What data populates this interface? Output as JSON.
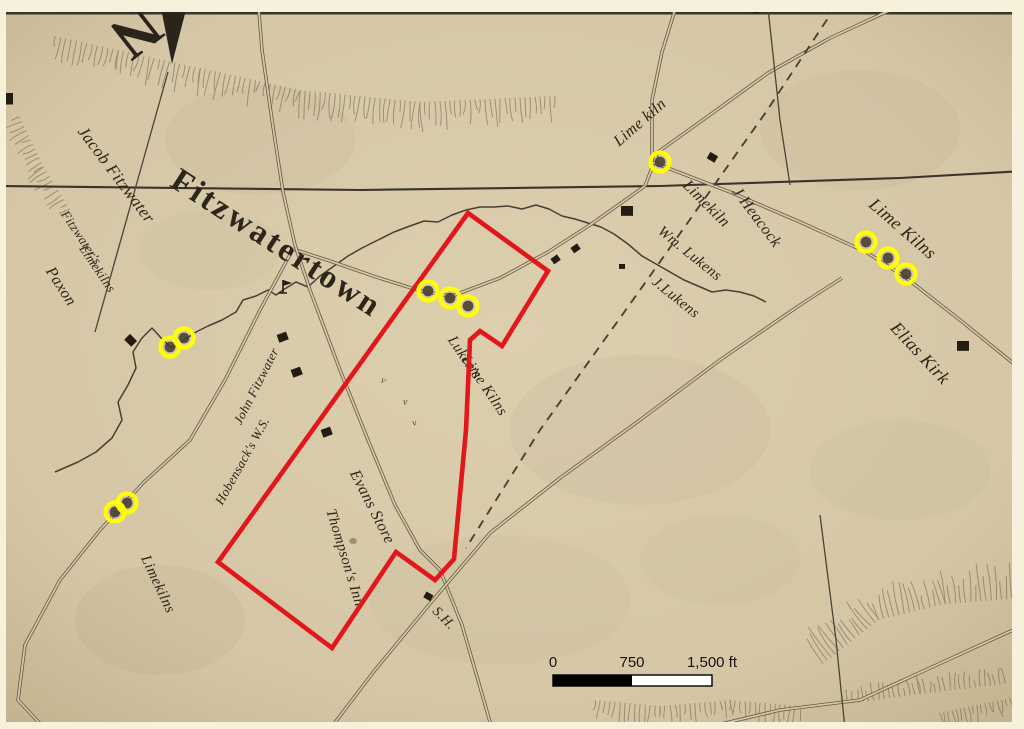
{
  "annotations": {
    "highlight_color": "#ffff00",
    "outline_color": "#e2161b",
    "highlight_meaning": "limekiln-site-circle",
    "outline_meaning": "study-area-polygon"
  },
  "scalebar": {
    "labels": [
      {
        "id": "start",
        "text": "0"
      },
      {
        "id": "mid",
        "text": "750"
      },
      {
        "id": "end",
        "text": "1,500 ft"
      }
    ],
    "bar": {
      "x": 553,
      "y": 675,
      "w": 159,
      "h": 11,
      "mid": 632
    }
  },
  "map": {
    "paper": "#d5c7a6",
    "border": "#f7f0db",
    "ink": "#2c2519",
    "road_ink": "#645847",
    "compass": {
      "letter": "N",
      "x": 124,
      "y": 16,
      "rot": 142,
      "size": 62,
      "arrow": [
        [
          172,
          64
        ],
        [
          159,
          -2
        ],
        [
          187,
          6
        ]
      ]
    },
    "labels": [
      {
        "id": "jacob-fitzwater",
        "text": "Jacob Fitzwater",
        "x": 112,
        "y": 178,
        "rot": 53,
        "size": 17,
        "italic": true
      },
      {
        "id": "fitzwatertown",
        "text": "Fitzwatertown",
        "x": 271,
        "y": 252,
        "rot": 33,
        "size": 33,
        "italic": false,
        "bold": true,
        "spacing": 3
      },
      {
        "id": "fitzwaters",
        "text": "Fitzwater's",
        "x": 78,
        "y": 240,
        "rot": 56,
        "size": 13,
        "italic": true
      },
      {
        "id": "fitzwaters-limekilns",
        "text": "Limekilns",
        "x": 94,
        "y": 271,
        "rot": 56,
        "size": 13,
        "italic": true
      },
      {
        "id": "paxon",
        "text": "Paxon",
        "x": 57,
        "y": 289,
        "rot": 57,
        "size": 16,
        "italic": true
      },
      {
        "id": "lime-kiln-top",
        "text": "Lime kiln",
        "x": 643,
        "y": 126,
        "rot": -41,
        "size": 16,
        "italic": true
      },
      {
        "id": "limekiln-mid",
        "text": "Limekiln",
        "x": 703,
        "y": 207,
        "rot": 45,
        "size": 16,
        "italic": true
      },
      {
        "id": "j-heacock",
        "text": "J Heacock",
        "x": 753,
        "y": 220,
        "rot": 53,
        "size": 16,
        "italic": true
      },
      {
        "id": "wm-lukens",
        "text": "Wm. Lukens",
        "x": 687,
        "y": 257,
        "rot": 39,
        "size": 15,
        "italic": true
      },
      {
        "id": "j-lukens",
        "text": "J.Lukens",
        "x": 673,
        "y": 301,
        "rot": 39,
        "size": 15,
        "italic": true
      },
      {
        "id": "lime-kilns-ne",
        "text": "Lime Kilns",
        "x": 899,
        "y": 233,
        "rot": 41,
        "size": 18,
        "italic": true
      },
      {
        "id": "elias-kirk",
        "text": "Elias Kirk",
        "x": 916,
        "y": 357,
        "rot": 47,
        "size": 18,
        "italic": true
      },
      {
        "id": "lukens-line1",
        "text": "Luken's",
        "x": 461,
        "y": 360,
        "rot": 56,
        "size": 15,
        "italic": true
      },
      {
        "id": "lukens-line2",
        "text": "Lime Kilns",
        "x": 481,
        "y": 388,
        "rot": 56,
        "size": 15,
        "italic": true
      },
      {
        "id": "john-fitzwater",
        "text": "John Fitzwater",
        "x": 260,
        "y": 388,
        "rot": -63,
        "size": 13,
        "italic": true
      },
      {
        "id": "hobensacks",
        "text": "Hobensack's W.S.",
        "x": 246,
        "y": 463,
        "rot": -61,
        "size": 13,
        "italic": true
      },
      {
        "id": "evans-store",
        "text": "Evans Store",
        "x": 368,
        "y": 509,
        "rot": 63,
        "size": 16,
        "italic": true
      },
      {
        "id": "thompsons-inn",
        "text": "Thompson's Inn",
        "x": 341,
        "y": 559,
        "rot": 73,
        "size": 15,
        "italic": true
      },
      {
        "id": "sh",
        "text": "S.H.",
        "x": 441,
        "y": 621,
        "rot": 45,
        "size": 14,
        "italic": true
      },
      {
        "id": "limekilns-sw",
        "text": "Limekilns",
        "x": 154,
        "y": 586,
        "rot": 65,
        "size": 15,
        "italic": true
      }
    ],
    "roads": [
      {
        "single": true,
        "pts": [
          [
            0,
            186
          ],
          [
            360,
            190
          ],
          [
            660,
            186
          ],
          [
            900,
            178
          ],
          [
            1024,
            171
          ]
        ]
      },
      {
        "pts": [
          [
            912,
            0
          ],
          [
            830,
            38
          ],
          [
            768,
            73
          ],
          [
            700,
            122
          ],
          [
            658,
            152
          ],
          [
            645,
            186
          ]
        ]
      },
      {
        "pts": [
          [
            645,
            186
          ],
          [
            590,
            225
          ],
          [
            548,
            252
          ],
          [
            500,
            278
          ],
          [
            452,
            296
          ],
          [
            424,
            292
          ]
        ]
      },
      {
        "pts": [
          [
            424,
            292
          ],
          [
            376,
            277
          ],
          [
            330,
            261
          ],
          [
            293,
            249
          ]
        ]
      },
      {
        "pts": [
          [
            652,
            162
          ],
          [
            730,
            192
          ],
          [
            800,
            222
          ],
          [
            866,
            252
          ],
          [
            905,
            277
          ],
          [
            960,
            320
          ],
          [
            1024,
            372
          ]
        ]
      },
      {
        "pts": [
          [
            283,
            192
          ],
          [
            295,
            245
          ],
          [
            310,
            290
          ],
          [
            340,
            370
          ],
          [
            368,
            440
          ],
          [
            395,
            505
          ],
          [
            420,
            550
          ],
          [
            440,
            570
          ]
        ]
      },
      {
        "pts": [
          [
            440,
            570
          ],
          [
            462,
            625
          ],
          [
            478,
            680
          ],
          [
            492,
            729
          ]
        ]
      },
      {
        "pts": [
          [
            330,
            729
          ],
          [
            375,
            670
          ],
          [
            428,
            606
          ],
          [
            490,
            533
          ],
          [
            560,
            478
          ],
          [
            640,
            420
          ],
          [
            720,
            360
          ],
          [
            800,
            305
          ],
          [
            842,
            278
          ]
        ]
      },
      {
        "pts": [
          [
            700,
            729
          ],
          [
            780,
            710
          ],
          [
            860,
            700
          ],
          [
            930,
            668
          ],
          [
            1024,
            625
          ]
        ]
      },
      {
        "pts": [
          [
            293,
            249
          ],
          [
            260,
            310
          ],
          [
            225,
            380
          ],
          [
            190,
            440
          ],
          [
            143,
            483
          ],
          [
            100,
            530
          ],
          [
            60,
            580
          ],
          [
            25,
            645
          ],
          [
            18,
            700
          ],
          [
            45,
            729
          ]
        ]
      },
      {
        "pts": [
          [
            283,
            192
          ],
          [
            272,
            120
          ],
          [
            262,
            50
          ],
          [
            258,
            0
          ]
        ]
      },
      {
        "pts": [
          [
            678,
            0
          ],
          [
            662,
            52
          ],
          [
            652,
            100
          ],
          [
            652,
            162
          ]
        ]
      }
    ],
    "property_lines": [
      [
        [
          168,
          72
        ],
        [
          95,
          332
        ]
      ],
      [
        [
          768,
          8
        ],
        [
          780,
          120
        ],
        [
          790,
          185
        ]
      ],
      [
        [
          820,
          515
        ],
        [
          836,
          640
        ],
        [
          845,
          729
        ]
      ]
    ],
    "dashed_lines": [
      [
        [
          836,
          6
        ],
        [
          766,
          112
        ],
        [
          640,
          290
        ],
        [
          540,
          430
        ],
        [
          466,
          548
        ]
      ]
    ],
    "creek": [
      [
        55,
        472
      ],
      [
        78,
        462
      ],
      [
        96,
        452
      ],
      [
        112,
        438
      ],
      [
        122,
        420
      ],
      [
        118,
        402
      ],
      [
        128,
        385
      ],
      [
        136,
        368
      ],
      [
        133,
        352
      ],
      [
        142,
        338
      ],
      [
        152,
        328
      ],
      [
        163,
        340
      ],
      [
        172,
        348
      ],
      [
        184,
        340
      ],
      [
        196,
        332
      ],
      [
        208,
        326
      ],
      [
        222,
        320
      ],
      [
        236,
        312
      ],
      [
        243,
        300
      ],
      [
        256,
        296
      ],
      [
        268,
        290
      ],
      [
        276,
        295
      ],
      [
        283,
        290
      ],
      [
        296,
        282
      ],
      [
        308,
        287
      ],
      [
        320,
        276
      ],
      [
        334,
        266
      ],
      [
        348,
        256
      ],
      [
        362,
        248
      ],
      [
        378,
        240
      ],
      [
        394,
        232
      ],
      [
        410,
        226
      ],
      [
        424,
        221
      ],
      [
        438,
        222
      ],
      [
        452,
        215
      ],
      [
        466,
        210
      ],
      [
        480,
        207
      ],
      [
        494,
        207
      ],
      [
        508,
        206
      ],
      [
        522,
        209
      ],
      [
        536,
        205
      ],
      [
        549,
        209
      ],
      [
        562,
        216
      ],
      [
        575,
        219
      ],
      [
        588,
        223
      ],
      [
        601,
        227
      ],
      [
        614,
        234
      ],
      [
        628,
        244
      ],
      [
        642,
        256
      ],
      [
        656,
        264
      ],
      [
        670,
        272
      ],
      [
        684,
        280
      ],
      [
        698,
        286
      ],
      [
        712,
        292
      ],
      [
        726,
        290
      ],
      [
        740,
        292
      ],
      [
        754,
        296
      ],
      [
        766,
        302
      ]
    ],
    "buildings": [
      [
        6,
        100,
        14,
        0
      ],
      [
        130,
        341,
        10,
        45
      ],
      [
        283,
        338,
        10,
        -20
      ],
      [
        297,
        373,
        10,
        -20
      ],
      [
        327,
        433,
        10,
        -20
      ],
      [
        627,
        212,
        12,
        0
      ],
      [
        712,
        158,
        9,
        30
      ],
      [
        622,
        267,
        6,
        0
      ],
      [
        556,
        260,
        8,
        -35
      ],
      [
        576,
        249,
        8,
        -35
      ],
      [
        963,
        347,
        12,
        0
      ],
      [
        428,
        597,
        8,
        30
      ],
      [
        755,
        10,
        9,
        15
      ]
    ],
    "kiln_circles": [
      [
        660,
        162
      ],
      [
        866,
        242
      ],
      [
        888,
        258
      ],
      [
        906,
        274
      ],
      [
        428,
        291
      ],
      [
        450,
        298
      ],
      [
        468,
        306
      ],
      [
        170,
        347
      ],
      [
        184,
        338
      ],
      [
        115,
        512
      ],
      [
        127,
        503
      ]
    ],
    "polygon": [
      [
        468,
        213
      ],
      [
        548,
        271
      ],
      [
        502,
        346
      ],
      [
        480,
        331
      ],
      [
        470,
        340
      ],
      [
        466,
        430
      ],
      [
        454,
        559
      ],
      [
        435,
        580
      ],
      [
        396,
        552
      ],
      [
        332,
        648
      ],
      [
        218,
        562
      ]
    ],
    "hachures": [
      {
        "ridge": [
          [
            55,
            38
          ],
          [
            118,
            52
          ],
          [
            200,
            70
          ],
          [
            300,
            92
          ],
          [
            420,
            104
          ],
          [
            555,
            98
          ]
        ],
        "len": 20,
        "spacing": 5,
        "side": 1
      },
      {
        "ridge": [
          [
            18,
            118
          ],
          [
            42,
            168
          ],
          [
            68,
            210
          ]
        ],
        "len": 14,
        "spacing": 5,
        "side": 1
      },
      {
        "ridge": [
          [
            822,
            662
          ],
          [
            878,
            618
          ],
          [
            945,
            602
          ],
          [
            1022,
            596
          ]
        ],
        "len": 26,
        "spacing": 5,
        "side": -1
      },
      {
        "ridge": [
          [
            848,
            702
          ],
          [
            920,
            692
          ],
          [
            1005,
            682
          ]
        ],
        "len": 13,
        "spacing": 5,
        "side": -1
      },
      {
        "ridge": [
          [
            595,
            702
          ],
          [
            660,
            708
          ],
          [
            730,
            702
          ],
          [
            800,
            708
          ]
        ],
        "len": 16,
        "spacing": 5,
        "side": 1
      },
      {
        "ridge": [
          [
            940,
            715
          ],
          [
            1010,
            700
          ]
        ],
        "len": 12,
        "spacing": 4,
        "side": 1
      }
    ],
    "blotches": [
      [
        260,
        140,
        95,
        55,
        0.05
      ],
      [
        640,
        430,
        130,
        75,
        0.05
      ],
      [
        160,
        620,
        85,
        55,
        0.06
      ],
      [
        860,
        130,
        100,
        60,
        0.05
      ],
      [
        500,
        600,
        130,
        65,
        0.04
      ],
      [
        900,
        470,
        90,
        50,
        0.045
      ],
      [
        210,
        250,
        70,
        40,
        0.045
      ],
      [
        720,
        560,
        80,
        45,
        0.04
      ],
      [
        353,
        541,
        4,
        3,
        0.6
      ]
    ],
    "specks": [
      [
        380,
        382,
        25
      ],
      [
        403,
        405,
        0
      ],
      [
        413,
        426,
        -15
      ]
    ],
    "flag_symbol": {
      "x": 283,
      "y": 288
    }
  }
}
